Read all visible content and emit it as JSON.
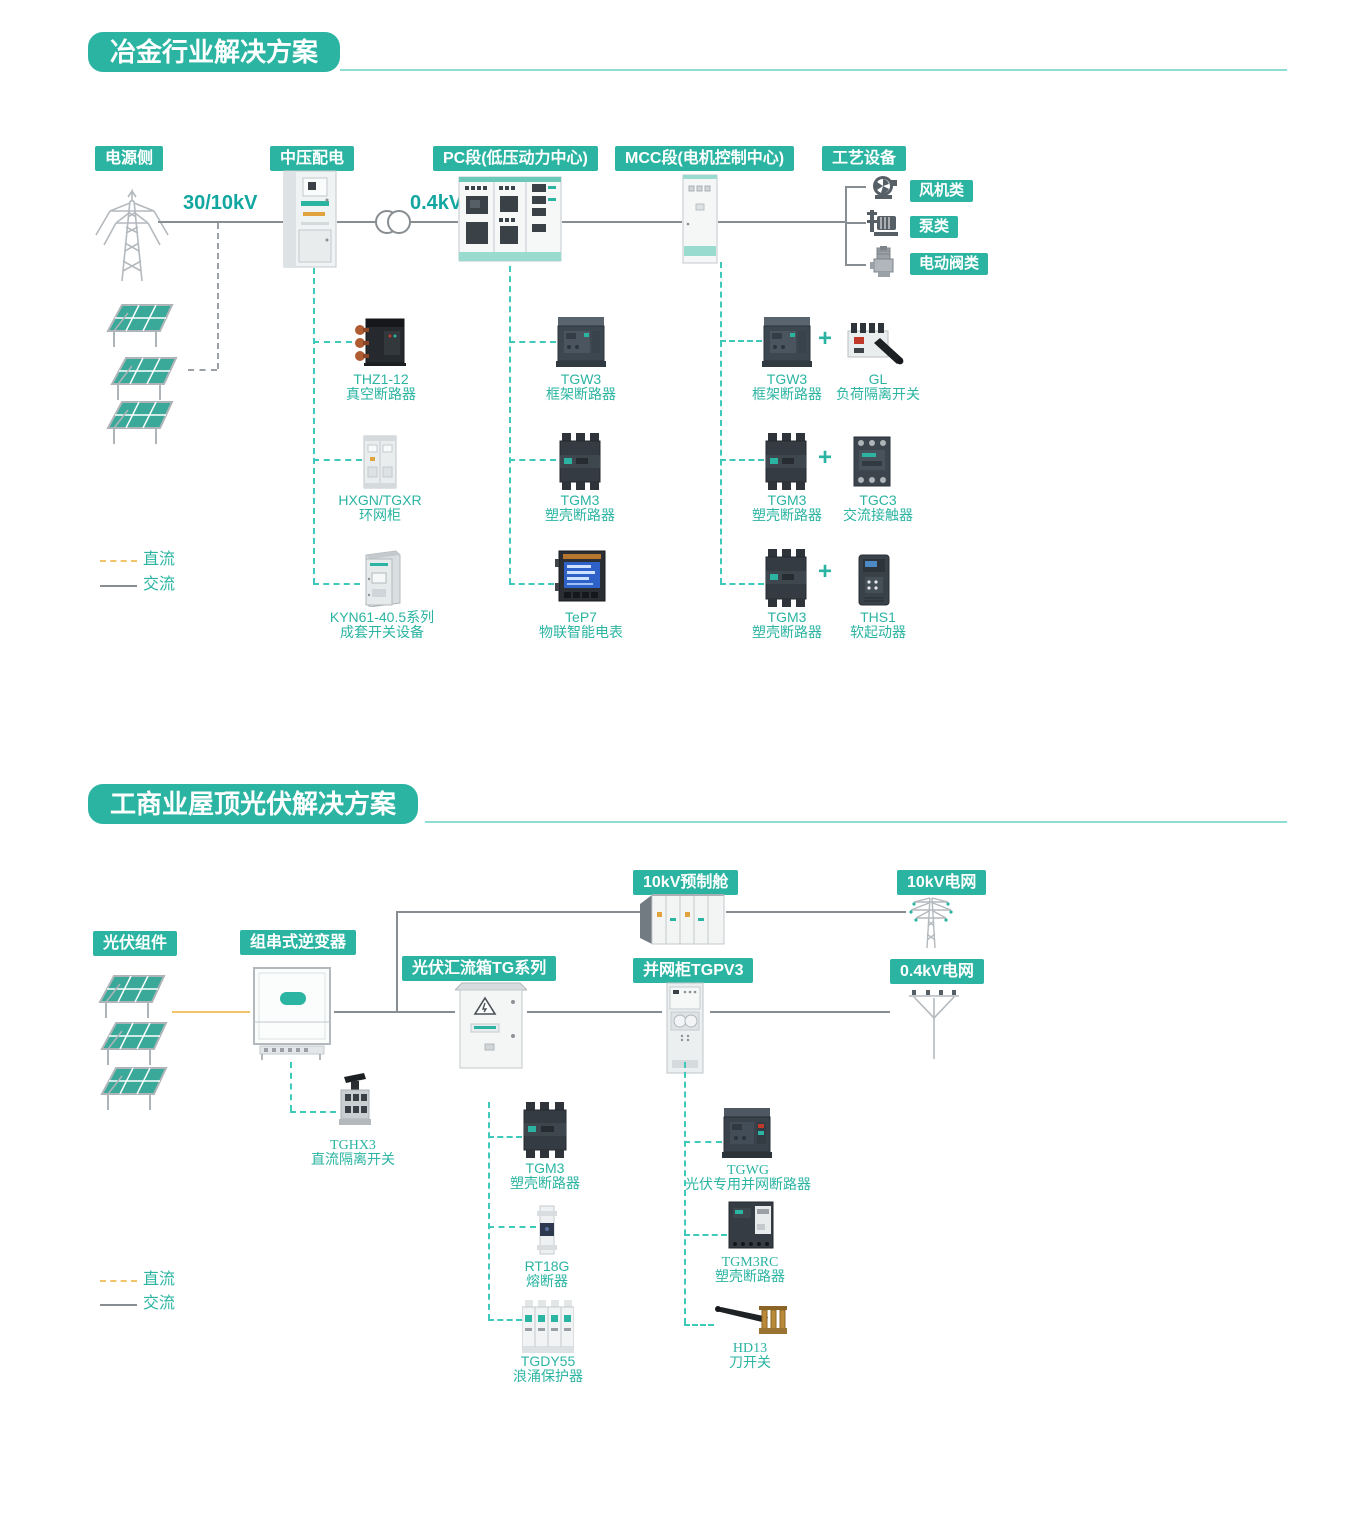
{
  "colors": {
    "brand": "#2bb4a2",
    "brand_light": "#8fdcd3",
    "teal_dash": "#3fc9ba",
    "gray_line": "#878d91",
    "orange_dc": "#f3c36a"
  },
  "legend": {
    "dc_label": "直流",
    "ac_label": "交流"
  },
  "section1": {
    "title": "冶金行业解决方案",
    "headers": {
      "power_side": "电源侧",
      "mv_distribution": "中压配电",
      "pc_section": "PC段(低压动力中心)",
      "mcc_section": "MCC段(电机控制中心)",
      "process_equipment": "工艺设备"
    },
    "voltages": {
      "incoming": "30/10kV",
      "low": "0.4kV"
    },
    "equipment_types": [
      "风机类",
      "泵类",
      "电动阀类"
    ],
    "plus_sign": "+",
    "mv_products": [
      {
        "model": "THZ1-12",
        "desc": "真空断路器"
      },
      {
        "model": "HXGN/TGXR",
        "desc": "环网柜"
      },
      {
        "model": "KYN61-40.5系列",
        "desc": "成套开关设备"
      }
    ],
    "pc_products": [
      {
        "model": "TGW3",
        "desc": "框架断路器"
      },
      {
        "model": "TGM3",
        "desc": "塑壳断路器"
      },
      {
        "model": "TeP7",
        "desc": "物联智能电表"
      }
    ],
    "mcc_products": [
      {
        "model": "TGW3",
        "desc": "框架断路器"
      },
      {
        "model": "TGM3",
        "desc": "塑壳断路器"
      },
      {
        "model": "TGM3",
        "desc": "塑壳断路器"
      }
    ],
    "mcc_partners": [
      {
        "model": "GL",
        "desc": "负荷隔离开关"
      },
      {
        "model": "TGC3",
        "desc": "交流接触器"
      },
      {
        "model": "THS1",
        "desc": "软起动器"
      }
    ]
  },
  "section2": {
    "title": "工商业屋顶光伏解决方案",
    "headers": {
      "pv_modules": "光伏组件",
      "string_inverter": "组串式逆变器",
      "combiner_box": "光伏汇流箱TG系列",
      "grid_cabinet": "并网柜TGPV3",
      "prefab_cabin": "10kV预制舱",
      "grid_10kv": "10kV电网",
      "grid_04kv": "0.4kV电网"
    },
    "inverter_products": [
      {
        "model": "TGHX3",
        "desc": "直流隔离开关"
      }
    ],
    "combiner_products": [
      {
        "model": "TGM3",
        "desc": "塑壳断路器"
      },
      {
        "model": "RT18G",
        "desc": "熔断器"
      },
      {
        "model": "TGDY55",
        "desc": "浪涌保护器"
      }
    ],
    "grid_cabinet_products": [
      {
        "model": "TGWG",
        "desc": "光伏专用并网断路器"
      },
      {
        "model": "TGM3RC",
        "desc": "塑壳断路器"
      },
      {
        "model": "HD13",
        "desc": "刀开关"
      }
    ]
  }
}
